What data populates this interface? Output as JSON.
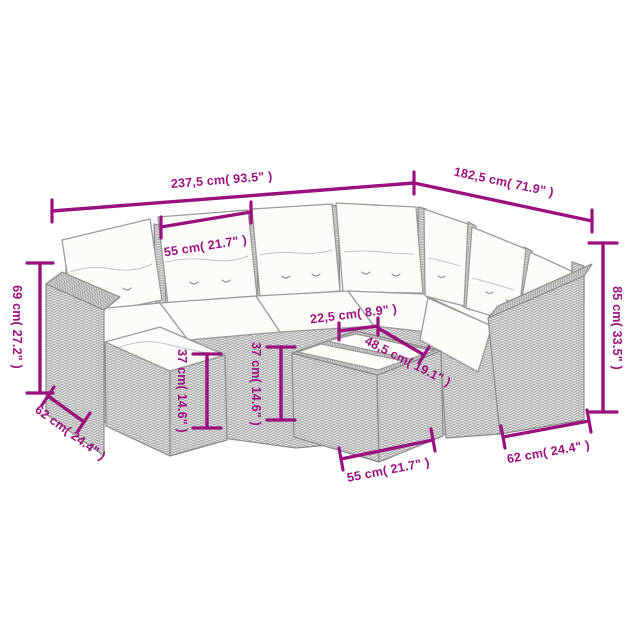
{
  "diagram": {
    "title": "rattan corner sofa set dimension diagram",
    "accent_color": "#9A117E",
    "furniture": {
      "items": [
        "corner-sofa",
        "footstool",
        "coffee-table"
      ],
      "rattan_color": "#dbdbdb",
      "cushion_color": "#fcfcf9"
    },
    "dimensions": {
      "total_width": "237,5 cm( 93.5\" )",
      "total_depth": "182,5 cm( 71.9\" )",
      "seat_width_top": "55 cm( 21.7\" )",
      "back_height": "69 cm( 27.2\" )",
      "left_seat_depth": "62 cm( 24.4\" )",
      "footstool_height": "37 cm( 14.6\" )",
      "table_height": "37 cm( 14.6\" )",
      "table_top_width": "22,5 cm( 8.9\" )",
      "table_top_length_diag": "48,5 cm( 19.1\" )",
      "table_length": "55 cm( 21.7\" )",
      "overall_height": "85 cm( 33.5\" )",
      "right_seat_depth": "62 cm( 24.4\" )"
    }
  }
}
